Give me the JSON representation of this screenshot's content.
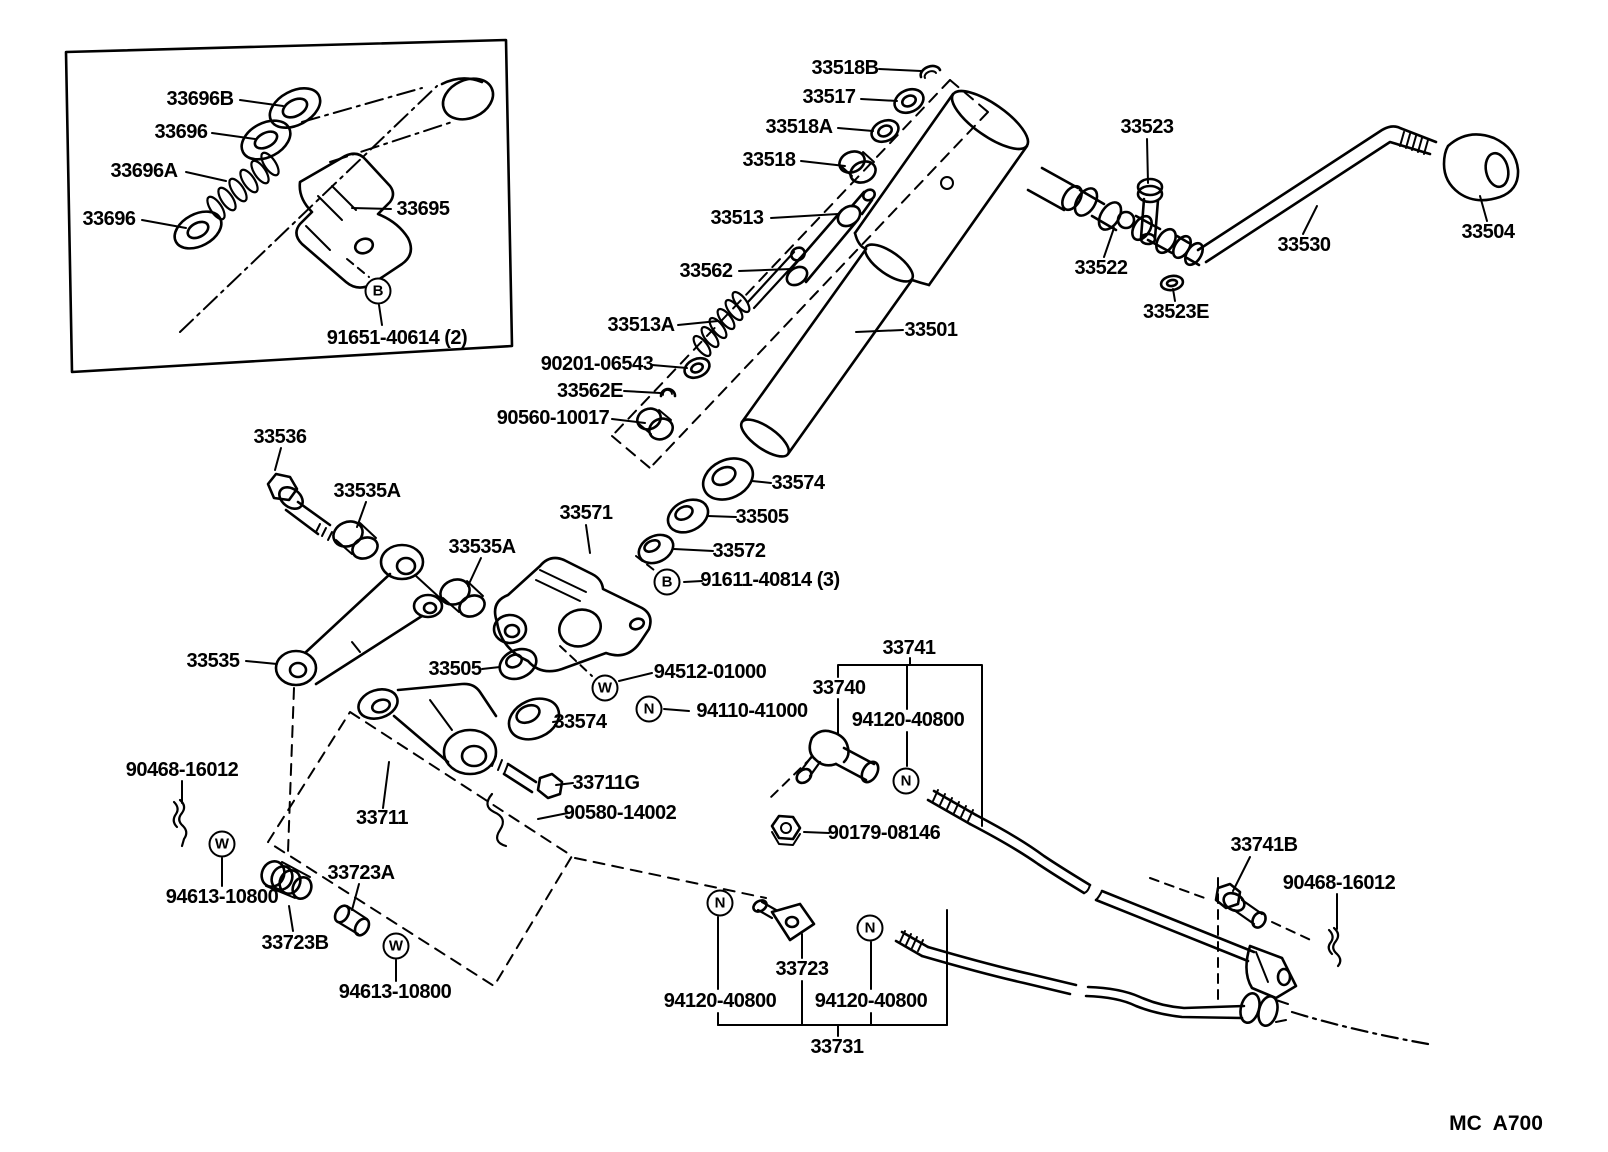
{
  "diagram": {
    "drawing_code": "MC  A700",
    "drawing_code_pos": {
      "x": 1496,
      "y": 1124
    }
  },
  "labels": [
    {
      "id": "33696B",
      "text": "33696B",
      "x": 200,
      "y": 99
    },
    {
      "id": "33696",
      "text": "33696",
      "x": 181,
      "y": 132
    },
    {
      "id": "33696A",
      "text": "33696A",
      "x": 144,
      "y": 171
    },
    {
      "id": "33696-2",
      "text": "33696",
      "x": 109,
      "y": 219
    },
    {
      "id": "33695",
      "text": "33695",
      "x": 423,
      "y": 209
    },
    {
      "id": "91651-40614",
      "text": "91651-40614 (2)",
      "x": 397,
      "y": 338
    },
    {
      "id": "33518B",
      "text": "33518B",
      "x": 845,
      "y": 68
    },
    {
      "id": "33517",
      "text": "33517",
      "x": 829,
      "y": 97
    },
    {
      "id": "33518A",
      "text": "33518A",
      "x": 799,
      "y": 127
    },
    {
      "id": "33518",
      "text": "33518",
      "x": 769,
      "y": 160
    },
    {
      "id": "33513",
      "text": "33513",
      "x": 737,
      "y": 218
    },
    {
      "id": "33562",
      "text": "33562",
      "x": 706,
      "y": 271
    },
    {
      "id": "33513A",
      "text": "33513A",
      "x": 641,
      "y": 325
    },
    {
      "id": "90201-06543",
      "text": "90201-06543",
      "x": 597,
      "y": 364
    },
    {
      "id": "33562E",
      "text": "33562E",
      "x": 590,
      "y": 391
    },
    {
      "id": "90560-10017",
      "text": "90560-10017",
      "x": 553,
      "y": 418
    },
    {
      "id": "33523",
      "text": "33523",
      "x": 1147,
      "y": 127
    },
    {
      "id": "33522",
      "text": "33522",
      "x": 1101,
      "y": 268
    },
    {
      "id": "33523E",
      "text": "33523E",
      "x": 1176,
      "y": 312
    },
    {
      "id": "33530",
      "text": "33530",
      "x": 1304,
      "y": 245
    },
    {
      "id": "33504",
      "text": "33504",
      "x": 1488,
      "y": 232
    },
    {
      "id": "33501",
      "text": "33501",
      "x": 931,
      "y": 330
    },
    {
      "id": "33536",
      "text": "33536",
      "x": 280,
      "y": 437
    },
    {
      "id": "33535A",
      "text": "33535A",
      "x": 367,
      "y": 491
    },
    {
      "id": "33535A-2",
      "text": "33535A",
      "x": 482,
      "y": 547
    },
    {
      "id": "33571",
      "text": "33571",
      "x": 586,
      "y": 513
    },
    {
      "id": "33574",
      "text": "33574",
      "x": 798,
      "y": 483
    },
    {
      "id": "33505",
      "text": "33505",
      "x": 762,
      "y": 517
    },
    {
      "id": "33572",
      "text": "33572",
      "x": 739,
      "y": 551
    },
    {
      "id": "91611-40814",
      "text": "91611-40814 (3)",
      "x": 770,
      "y": 580
    },
    {
      "id": "33535",
      "text": "33535",
      "x": 213,
      "y": 661
    },
    {
      "id": "33505-2",
      "text": "33505",
      "x": 455,
      "y": 669
    },
    {
      "id": "94512-01000",
      "text": "94512-01000",
      "x": 710,
      "y": 672
    },
    {
      "id": "94110-41000",
      "text": "94110-41000",
      "x": 752,
      "y": 711
    },
    {
      "id": "33574-2",
      "text": "33574",
      "x": 580,
      "y": 722
    },
    {
      "id": "33711G",
      "text": "33711G",
      "x": 606,
      "y": 783
    },
    {
      "id": "90580-14002",
      "text": "90580-14002",
      "x": 620,
      "y": 813
    },
    {
      "id": "33711",
      "text": "33711",
      "x": 382,
      "y": 818
    },
    {
      "id": "90468-16012",
      "text": "90468-16012",
      "x": 182,
      "y": 770
    },
    {
      "id": "94613-10800",
      "text": "94613-10800",
      "x": 222,
      "y": 897
    },
    {
      "id": "33723B",
      "text": "33723B",
      "x": 295,
      "y": 943
    },
    {
      "id": "33723A",
      "text": "33723A",
      "x": 361,
      "y": 873
    },
    {
      "id": "94613-10800-2",
      "text": "94613-10800",
      "x": 395,
      "y": 992
    },
    {
      "id": "33741",
      "text": "33741",
      "x": 909,
      "y": 648
    },
    {
      "id": "33740",
      "text": "33740",
      "x": 839,
      "y": 688
    },
    {
      "id": "94120-40800",
      "text": "94120-40800",
      "x": 908,
      "y": 720
    },
    {
      "id": "90179-08146",
      "text": "90179-08146",
      "x": 884,
      "y": 833
    },
    {
      "id": "33723",
      "text": "33723",
      "x": 802,
      "y": 969
    },
    {
      "id": "94120-40800-2",
      "text": "94120-40800",
      "x": 720,
      "y": 1001
    },
    {
      "id": "94120-40800-3",
      "text": "94120-40800",
      "x": 871,
      "y": 1001
    },
    {
      "id": "33731",
      "text": "33731",
      "x": 837,
      "y": 1047
    },
    {
      "id": "33741B",
      "text": "33741B",
      "x": 1264,
      "y": 845
    },
    {
      "id": "90468-16012-2",
      "text": "90468-16012",
      "x": 1339,
      "y": 883
    }
  ],
  "markers": [
    {
      "id": "B1",
      "letter": "B",
      "x": 378,
      "y": 291
    },
    {
      "id": "B2",
      "letter": "B",
      "x": 667,
      "y": 582
    },
    {
      "id": "W1",
      "letter": "W",
      "x": 605,
      "y": 688
    },
    {
      "id": "N1",
      "letter": "N",
      "x": 649,
      "y": 709
    },
    {
      "id": "W2",
      "letter": "W",
      "x": 222,
      "y": 844
    },
    {
      "id": "W3",
      "letter": "W",
      "x": 396,
      "y": 946
    },
    {
      "id": "N2",
      "letter": "N",
      "x": 906,
      "y": 781
    },
    {
      "id": "N3",
      "letter": "N",
      "x": 720,
      "y": 903
    },
    {
      "id": "N4",
      "letter": "N",
      "x": 870,
      "y": 928
    }
  ]
}
